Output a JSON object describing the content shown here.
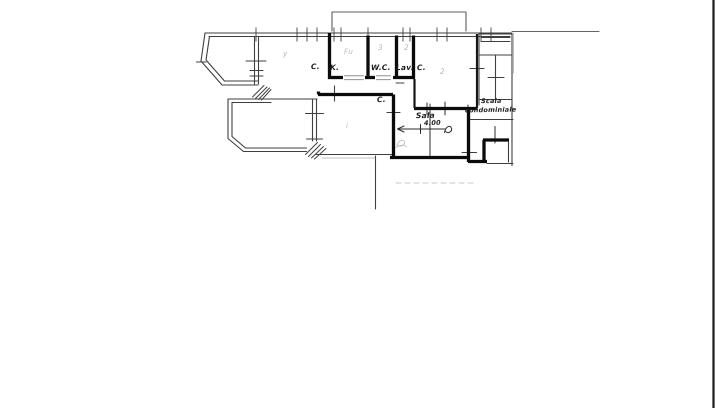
{
  "palette": {
    "paper": "#ffffff",
    "ink": "#3f3f3f",
    "wall_ink": "#0b0b0b",
    "faint_ink": "#909090",
    "page_edge": "#1c1c1c"
  },
  "plan": {
    "room_labels": [
      {
        "text": "C."
      },
      {
        "text": "K."
      },
      {
        "text": "W.C."
      },
      {
        "text": "Lav."
      },
      {
        "text": "C."
      },
      {
        "text": "C."
      },
      {
        "text": "Sala"
      }
    ],
    "stairwell": {
      "line1": "Scala",
      "line2": "condominiale"
    },
    "dimension_label": "4.00",
    "pencil_marks": [
      {
        "text": "y"
      },
      {
        "text": "Fu"
      },
      {
        "text": "3"
      },
      {
        "text": "2"
      },
      {
        "text": "2"
      },
      {
        "text": "i"
      }
    ]
  }
}
